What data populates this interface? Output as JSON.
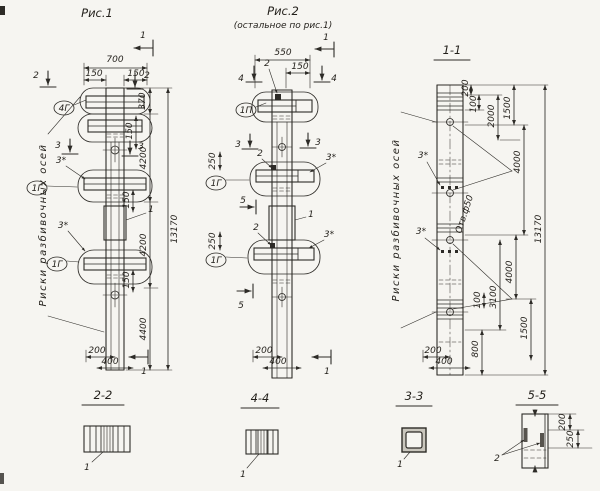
{
  "colors": {
    "ink": "#2d2b27",
    "paper": "#f6f5f1"
  },
  "fig1": {
    "title": "Рис.1",
    "note": "Риски разбивочных осей",
    "cut1": "1",
    "cut1b": "1",
    "cut2l": "2",
    "cut2r": "2",
    "cut3l": "3",
    "cut3r": "3",
    "star_a": "3*",
    "star_b": "3*",
    "co_top": "4Г",
    "co_mid": "1Г",
    "co_bot": "1Г",
    "panel": "1",
    "d700": "700",
    "d150l": "150",
    "d150r": "150",
    "d370": "370",
    "s150a": "150",
    "s150b": "150",
    "s150c": "150",
    "d4200a": "4200",
    "d4200b": "4200",
    "d4400": "4400",
    "total": "13170",
    "d200": "200",
    "d400": "400"
  },
  "fig2": {
    "title": "Рис.2",
    "subtitle": "(остальное по рис.1)",
    "cut1": "1",
    "cut1b": "1",
    "cut4l": "4",
    "cut4r": "4",
    "cut3l": "3",
    "cut3r": "3",
    "cut5a": "5",
    "cut5b": "5",
    "m2top": "2",
    "m2mid": "2",
    "m2low": "2",
    "d550": "550",
    "d150": "150",
    "d250a": "250",
    "d250b": "250",
    "co_top": "1П",
    "co_mid": "1Г",
    "co_bot": "1Г",
    "star_a": "3*",
    "star_b": "3*",
    "panel": "1",
    "d200": "200",
    "d400": "400"
  },
  "sec11": {
    "title": "1-1",
    "note": "Риски разбивочных осей",
    "star_a": "3*",
    "star_b": "3*",
    "hole": "Отв.ф50",
    "d200t": "200",
    "d100t": "100",
    "d2000": "2000",
    "d1500t": "1500",
    "d4000t": "4000",
    "d4000b": "4000",
    "d3100": "3100",
    "d100b": "100",
    "d1500b": "1500",
    "d800": "800",
    "total": "13170",
    "d200": "200",
    "d400": "400"
  },
  "sec22": {
    "title": "2-2",
    "label": "1"
  },
  "sec44": {
    "title": "4-4",
    "label": "1"
  },
  "sec33": {
    "title": "3-3",
    "label": "1"
  },
  "sec55": {
    "title": "5-5",
    "label": "2",
    "d200": "200",
    "d250": "250"
  }
}
